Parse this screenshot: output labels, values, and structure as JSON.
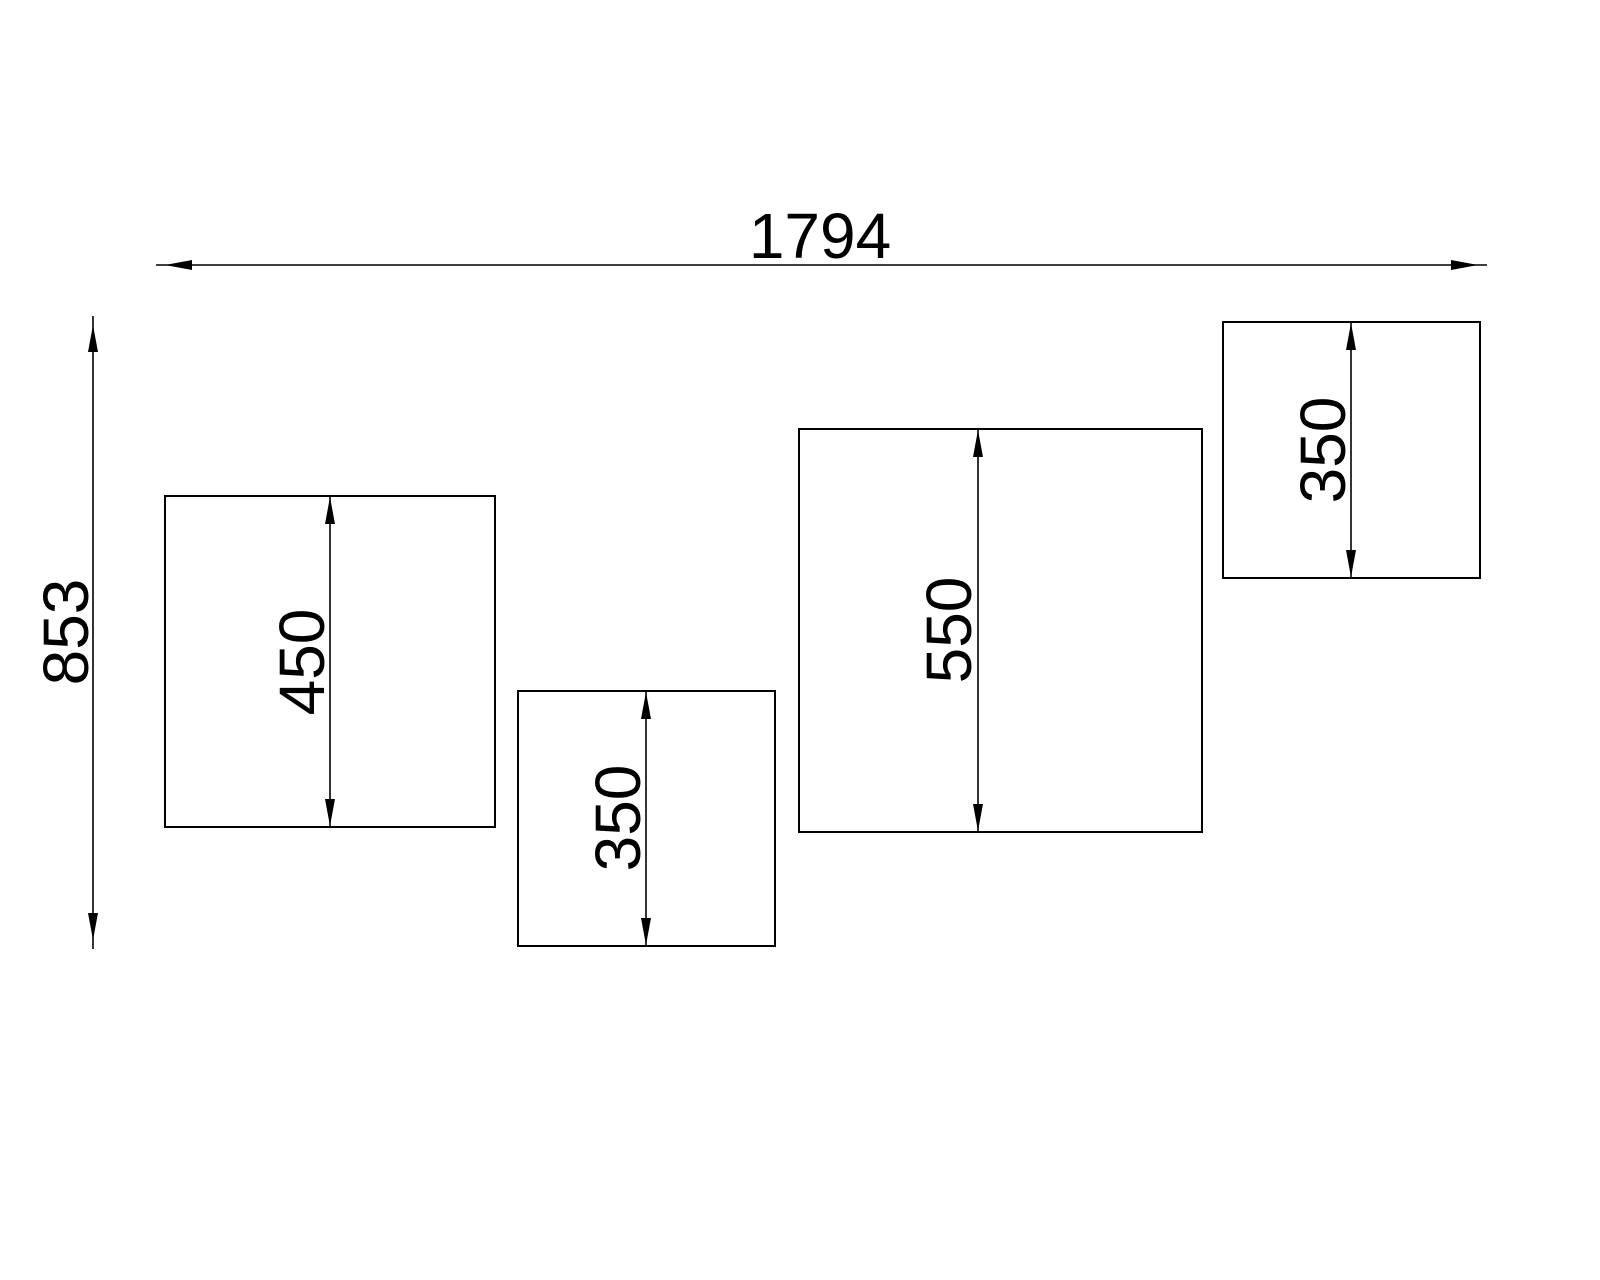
{
  "page": {
    "background_color": "#ffffff",
    "line_color": "#000000"
  },
  "drawing": {
    "overall_width_label": "1794",
    "overall_height_label": "853",
    "panels": [
      {
        "id": "panel-1",
        "height_label": "450"
      },
      {
        "id": "panel-2",
        "height_label": "350"
      },
      {
        "id": "panel-3",
        "height_label": "550"
      },
      {
        "id": "panel-4",
        "height_label": "350"
      }
    ]
  }
}
